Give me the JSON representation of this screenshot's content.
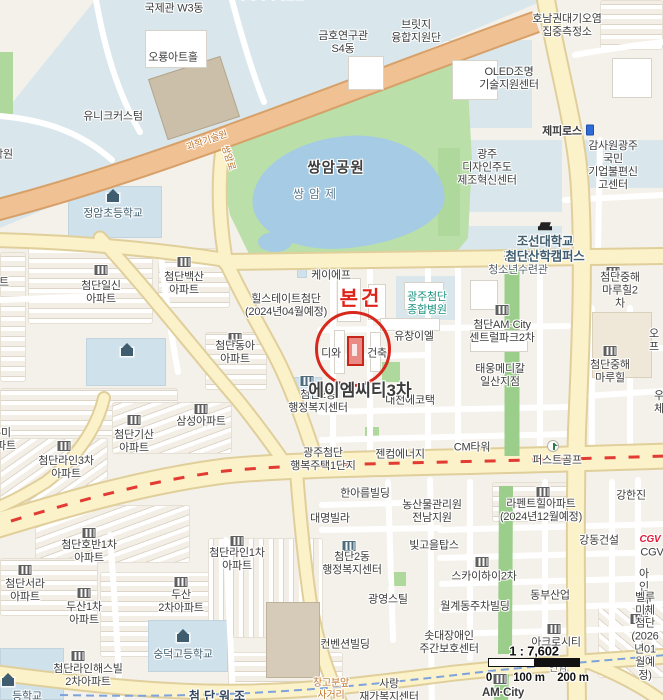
{
  "map_type": "area-location-map",
  "annotation": {
    "subject_label": "본건",
    "accent_red": "#d7281d"
  },
  "scale": {
    "ratio": "1 : 7,602",
    "tick0": "0",
    "tick100": "100 m",
    "tick200": "200 m"
  },
  "colors": {
    "road_major_yellow": "#fbf2c9",
    "road_highway_orange": "#f0c193",
    "park_green": "#badfa9",
    "water_blue": "#a6cbe4",
    "median_green": "#9bce8a",
    "brt_dash_red": "#e13b33",
    "boundary_dash_blue": "#7ea2dc",
    "hospital_teal": "#18927e",
    "school_slate": "#3f5d6e",
    "cgv_red": "#e31837"
  },
  "icons": {
    "apartment": "building-columns-gray",
    "government": "building-columns-blue",
    "school": "schoolhouse-slate",
    "golf": "golf-flag",
    "poi_marker": "blue-flag-marker",
    "university": "graduation-cap"
  },
  "labels": {
    "gukjegwan": "국제관 W3동",
    "energyhall": "국가에너지체험관",
    "oryong": "오룡아트홀",
    "unique": "유니크커스텀",
    "bridge": "브릿지\n융합지원단",
    "geumho": "금호연구관\nS4동",
    "honam": "호남권대기오염\n집중측정소",
    "oled": "OLED조명\n기술지원센터",
    "zephyros": "제피로스",
    "hagwon": "학원",
    "sci_road": "과학기술원",
    "ssangam_ro": "쌍암로",
    "jeongam": "정암초등학교",
    "ssangam_park": "쌍암공원",
    "ssangamje": "쌍암제",
    "gwangsan": "광산구\n청소년수련관",
    "chosun": "조선대학교\n첨단산학캠퍼스",
    "design": "광주\n디자인주도\n제조혁신센터",
    "gamsawon": "감사원광주국민\n기업불편신고센터",
    "kf": "케이에프",
    "hillstate": "힐스테이트첨단\n(2024년04월예정)",
    "hospital": "광주첨단\n종합병원",
    "yuchang": "유창이엘",
    "diwa": "디와",
    "geonchuk": "건축",
    "amct3": "에이엠씨티3차",
    "admin1": "첨단2동\n행정복지센터",
    "daecheon": "대천에코택",
    "taewoong": "태웅메디칼\n일산지점",
    "amcity2": "첨단AM·City\n센트럴파크2차",
    "junghae2": "첨단중해마루힐2차",
    "junghae1": "첨단중해\n마루힐",
    "opeu": "오프",
    "uche": "우체",
    "gencom": "젠컴에너지",
    "cmtower": "CM타워",
    "firstgolf": "퍼스트골프",
    "haengbok": "광주첨단\n행복주택1단지",
    "donga": "첨단동아\n아파트",
    "ilsin": "첨단일신\n아파트",
    "baeksan": "첨단백산\n아파트",
    "samsung": "삼성아파트",
    "umi": "우미\n아파트",
    "apt_cut": "아파트",
    "line3": "첨단라인3차\n아파트",
    "gisan": "첨단기산\n아파트",
    "hoban": "첨단호반1차\n아파트",
    "seora": "첨단서라\n아파트",
    "dusan1": "두산1차\n아파트",
    "dusan2": "두산\n2차아파트",
    "sungduk": "숭덕고등학교",
    "haesville": "첨단라인해스빌\n2차아파트",
    "line1": "첨단라인1차\n아파트",
    "admin2": "첨단2동\n행정복지센터",
    "hanareum": "한아름빌딩",
    "nongsanmul": "농산물관리원\n전남지원",
    "lafent": "라펜트힐아파트\n(2024년12월예정)",
    "kanghanjin": "강한진",
    "daemyung": "대명빌라",
    "bitgoeul": "빛고을탑스",
    "kangdong": "강동건설",
    "cgv": "CGV",
    "skyhigh": "스카이하이2차",
    "dongbu": "동부산업",
    "ain": "아인씨앤",
    "gwangyoung": "광영스틸",
    "wolgye": "월계동주차빌딩",
    "sotdae": "솟대장애인\n주간보호센터",
    "acro": "아크로시티",
    "bellumiche": "벨루미체첨단\n(2026년01월예정)",
    "convention": "컨벤션빌딩",
    "sarang": "사랑\n재가복지센터",
    "changgo": "창고분앞\n사거리",
    "spaced_dong": "첨단워조",
    "school_cut": "등학교",
    "yeonam": "연암",
    "amcity_bottom": "AM·City"
  }
}
